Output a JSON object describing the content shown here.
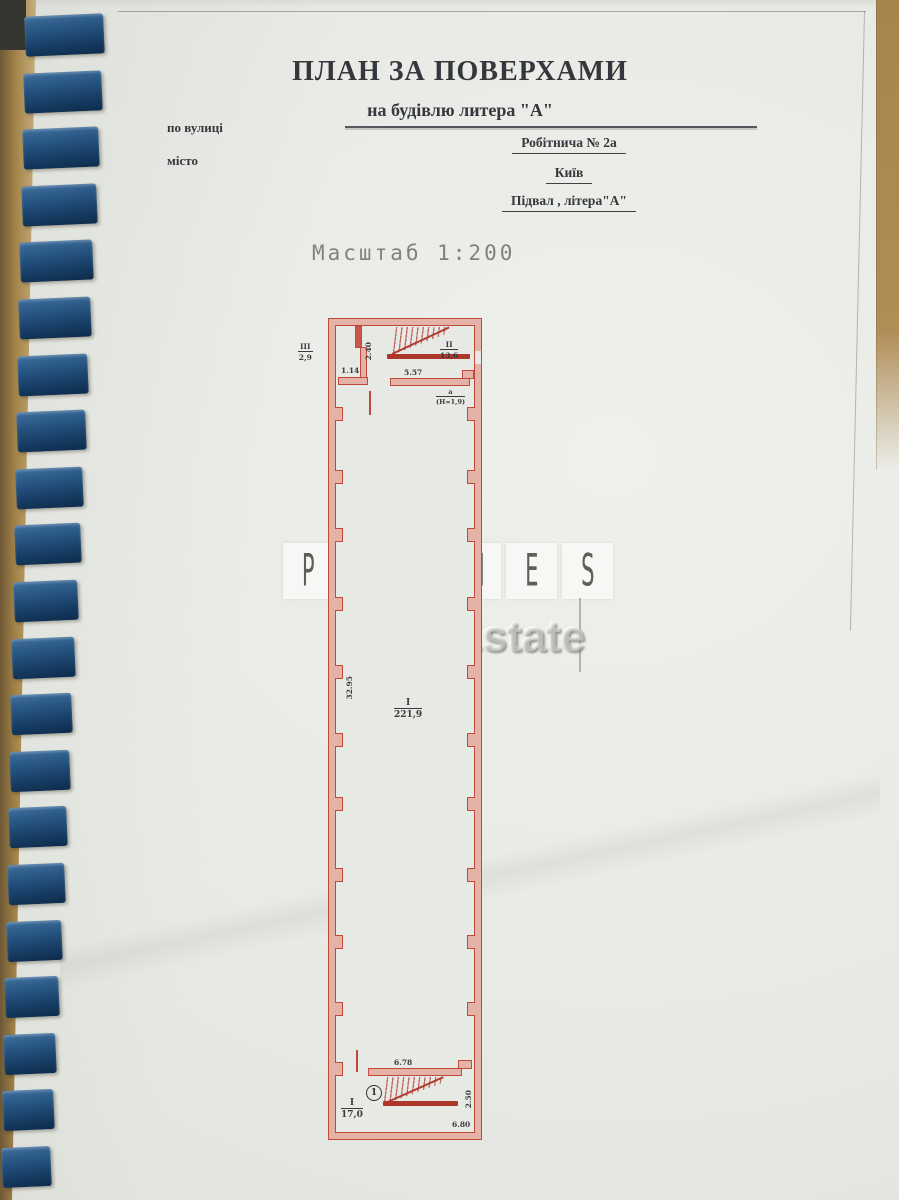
{
  "document": {
    "title": "ПЛАН ЗА ПОВЕРХАМИ",
    "subtitle": "на будівлю литера \"А\"",
    "street_label": "по вулиці",
    "city_label": "місто",
    "street_value": "Робітнича  № 2а",
    "city_value": "Київ",
    "level_value": "Підвал , літера\"А\"",
    "scale": "Масштаб 1:200"
  },
  "watermark": {
    "brand_letters": [
      "P",
      "R",
      "i",
      "M",
      "E",
      "S"
    ],
    "subtitle": "Real Estate"
  },
  "plan": {
    "rooms": {
      "room_3": {
        "num": "III",
        "den": "2,9"
      },
      "room_2": {
        "num": "II",
        "den": "13,6"
      },
      "room_a": {
        "num": "а",
        "den": "(Н=1,9)"
      },
      "room_1_main": {
        "num": "I",
        "den": "221,9"
      },
      "room_1_stair": {
        "num": "I",
        "den": "17,0"
      }
    },
    "dims": {
      "d_114": "1.14",
      "d_240": "2.40",
      "d_557": "5.57",
      "d_3295": "32.95",
      "d_678": "6.78",
      "d_250": "2.50",
      "d_680": "6.80"
    },
    "stair_number": "1",
    "colors": {
      "wall_line": "#bf4a3c",
      "wall_fill": "#e4b2a7"
    }
  }
}
